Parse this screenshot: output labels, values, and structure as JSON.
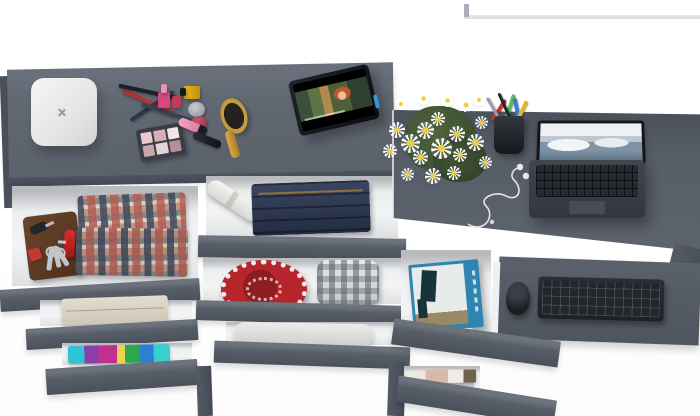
{
  "scene": {
    "title": "Top-down 3D render: gray dresser and desk combo with open drawers, no visible text",
    "type": "furniture-product-render",
    "view": "top-down"
  },
  "palette": {
    "background": "#ffffff",
    "furniture_gray": "#5f6670",
    "drawer_front_gray": "#565c66",
    "drawer_interior": "#f0f1f2",
    "accent_red": "#b6252b",
    "denim_blue": "#2c3650",
    "wood_gold": "#c79a3a",
    "book_blue": "#2e86b0",
    "daisy_white": "#ffffff",
    "daisy_center_yellow": "#f0cf3c"
  },
  "areas": {
    "dresser_top": {
      "items": [
        "white rounded jewelry box with x logo",
        "crossed makeup pencils",
        "pink nail polish",
        "yellow nail polish",
        "silver cream jar",
        "red cream jar",
        "eyeshadow palette with pink pans",
        "pink lip gloss tube",
        "black mascara tube",
        "golden wooden hairbrush",
        "tablet propped up playing an animated movie with red-haired character"
      ]
    },
    "left_drawers": {
      "items": [
        "brown leather wallet",
        "car key fob",
        "red pocket knife",
        "key bunch on ring",
        "red tag",
        "folded red-gray plaid shirts",
        "folded beige towel",
        "stack of bright folded clothes (cyan, purple, magenta, green)"
      ]
    },
    "middle_drawers": {
      "items": [
        "rolled white paper",
        "folded jeans stack",
        "red crocheted round piece",
        "rolled gray plaid blanket",
        "rolled white duvet"
      ]
    },
    "right_desk": {
      "items": [
        "bouquet of white daisies with green leaves",
        "black pen cup with colored pens and scissors",
        "white earbuds with cable",
        "open laptop showing snowy mountain wallpaper"
      ]
    },
    "keyboard_tray": {
      "items": [
        "black wireless keyboard",
        "black mouse"
      ]
    },
    "right_pedestal": {
      "items": [
        "blue paperback book with figure artwork",
        "white organizer tray",
        "stack of magazines"
      ]
    }
  }
}
